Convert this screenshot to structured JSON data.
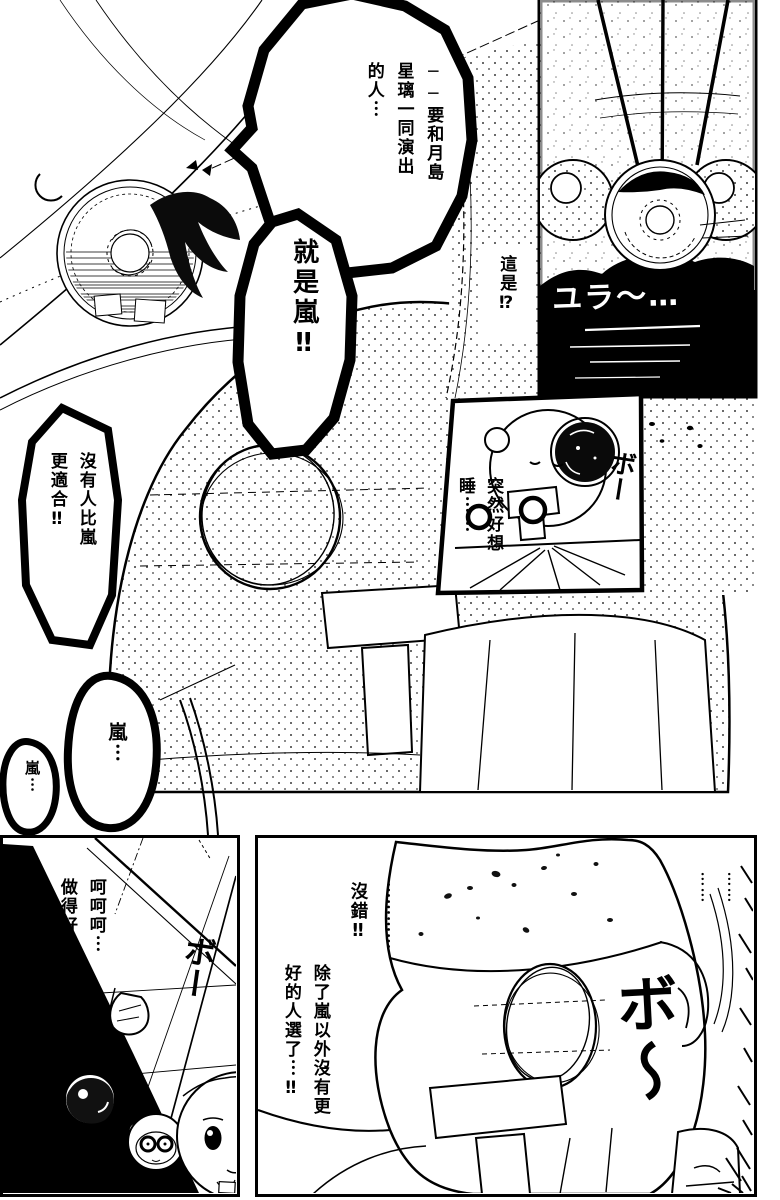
{
  "colors": {
    "ink": "#000000",
    "paper": "#ffffff"
  },
  "panels": {
    "top_scene": {
      "bubble_cast": {
        "cols": [
          "──要和月島",
          "星璃一同演出",
          "的人︙"
        ]
      },
      "bubble_is_arashi": {
        "cols": [
          "就是嵐‼"
        ]
      },
      "caption_what_is_this": {
        "cols": [
          "這是⁉"
        ]
      },
      "bubble_no_one_better": {
        "cols": [
          "沒有人比嵐",
          "更適合‼"
        ]
      },
      "bubble_arashi_echo_big": {
        "cols": [
          "嵐︙"
        ]
      },
      "bubble_arashi_echo_small": {
        "cols": [
          "嵐︙"
        ]
      }
    },
    "hypno_inset": {
      "sfx_sway": "ユラ〜…"
    },
    "sleepy_inset": {
      "dialogue": {
        "cols": [
          "突然好想",
          "睡︙︙"
        ]
      },
      "sfx_daze": "ボー"
    },
    "bottom_left": {
      "dialogue": {
        "cols": [
          "呵呵呵︙",
          "做得好～～"
        ]
      },
      "sfx_daze": "ボー"
    },
    "bottom_right": {
      "ellipsis_long": "︙︙︙︙",
      "agree": "沒錯‼",
      "dialogue": {
        "cols": [
          "除了嵐以外沒有更",
          "好的人選了︙‼"
        ]
      },
      "ellipsis_pair": [
        "︙︙",
        "︙︙"
      ],
      "sfx_daze_big": "ボ〜"
    }
  }
}
